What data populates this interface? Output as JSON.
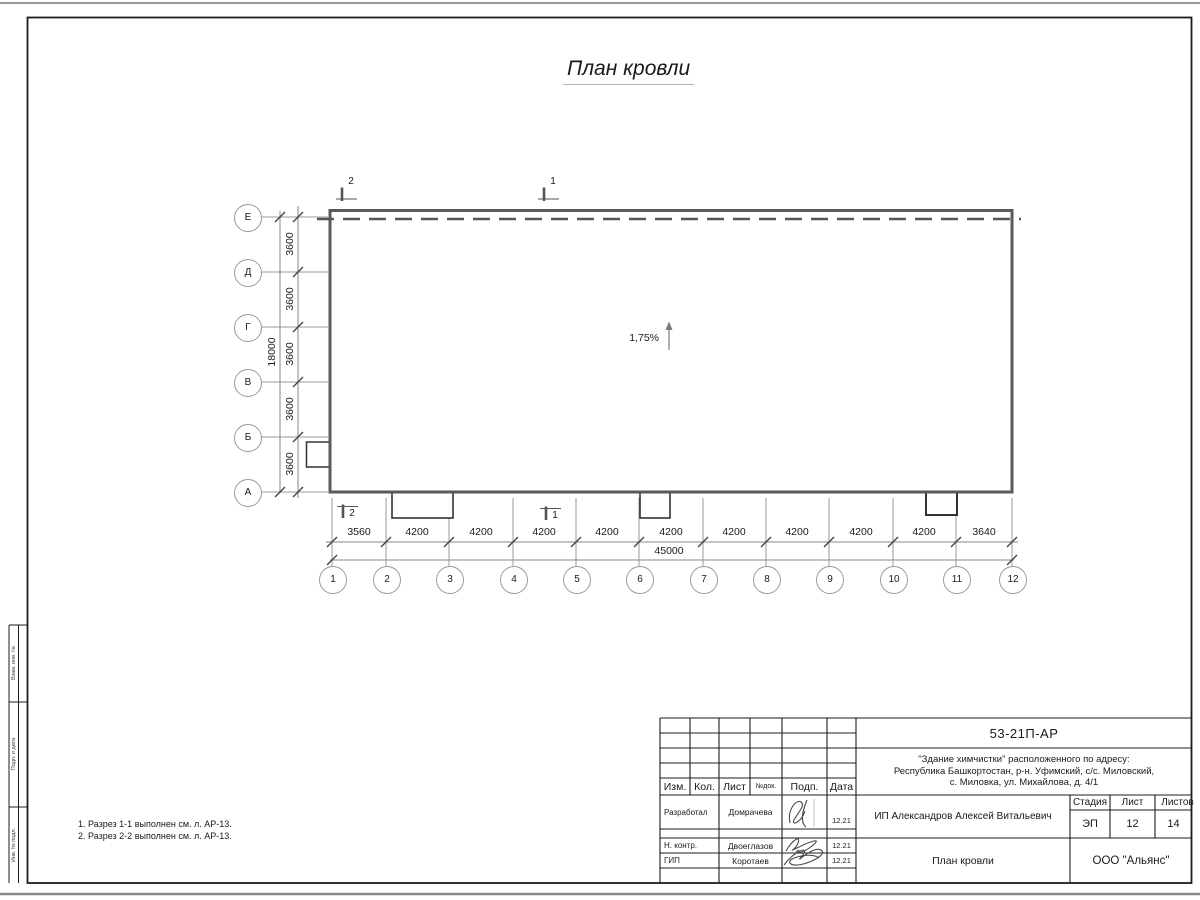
{
  "sheet": {
    "title": "План кровли",
    "slope_label": "1,75%",
    "notes": [
      "1. Разрез 1-1 выполнен см. л. АР-13.",
      "2. Разрез 2-2 выполнен см. л. АР-13."
    ]
  },
  "plan": {
    "section_marks": {
      "top_2": "2",
      "top_1": "1",
      "bottom_2": "2",
      "bottom_1": "1"
    },
    "axes_vertical": [
      "Е",
      "Д",
      "Г",
      "В",
      "Б",
      "А"
    ],
    "axes_horizontal": [
      "1",
      "2",
      "3",
      "4",
      "5",
      "6",
      "7",
      "8",
      "9",
      "10",
      "11",
      "12"
    ],
    "dims_vertical_segments": [
      "3600",
      "3600",
      "3600",
      "3600",
      "3600"
    ],
    "dim_vertical_total": "18000",
    "dims_horizontal_segments": [
      "3560",
      "4200",
      "4200",
      "4200",
      "4200",
      "4200",
      "4200",
      "4200",
      "4200",
      "4200",
      "3640"
    ],
    "dim_horizontal_total": "45000"
  },
  "frame": {
    "side_labels": [
      "Взам. инв. №",
      "Подп. и дата",
      "Инв. № подл."
    ]
  },
  "titleblock": {
    "doc_number": "53-21П-АР",
    "project_line1": "\"Здание химчистки\" расположенного по адресу:",
    "project_line2": "Республика Башкортостан, р-н. Уфимский, с/с. Миловский,",
    "project_line3": "с. Миловка, ул. Михайлова, д. 4/1",
    "header_cols": [
      "Изм.",
      "Кол.",
      "Лист",
      "№док.",
      "Подп.",
      "Дата"
    ],
    "rows": [
      {
        "role": "Разработал",
        "name": "Домрачева",
        "date": "12.21"
      },
      {
        "role": "Н. контр.",
        "name": "Двоеглазов",
        "date": "12.21"
      },
      {
        "role": "ГИП",
        "name": "Коротаев",
        "date": "12.21"
      }
    ],
    "client": "ИП Александров Алексей Витальевич",
    "stage_label": "Стадия",
    "stage_value": "ЭП",
    "sheet_label": "Лист",
    "sheet_value": "12",
    "sheets_label": "Листов",
    "sheets_value": "14",
    "drawing_title": "План кровли",
    "company": "ООО \"Альянс\""
  }
}
